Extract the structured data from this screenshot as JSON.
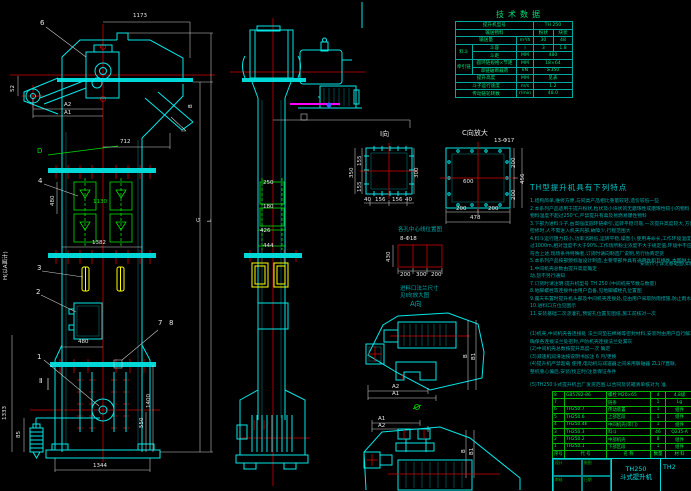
{
  "tech_table": {
    "title": "技术数据",
    "rows": [
      {
        "label": "提升机型号",
        "unit": "",
        "v1": "TH 250",
        "v2": ""
      },
      {
        "label": "输送物料",
        "unit": "",
        "v1": "粉状",
        "v2": "块状"
      },
      {
        "label": "输送量",
        "unit": "m³/h",
        "v1": "30",
        "v2": "48"
      },
      {
        "group": "料斗",
        "label": "斗容",
        "unit": "l",
        "v1": "3",
        "v2": "1.8"
      },
      {
        "group": "料斗",
        "label": "斗距",
        "unit": "MM",
        "v1": "480",
        "v2": ""
      },
      {
        "group": "牵引链",
        "label": "圆环链规格×节距",
        "unit": "MM",
        "v1": "18×64",
        "v2": ""
      },
      {
        "group": "牵引链",
        "label": "单链破断载荷",
        "unit": "kN",
        "v1": "≥350",
        "v2": ""
      },
      {
        "label": "提升高度",
        "unit": "MM",
        "v1": "见表",
        "v2": ""
      },
      {
        "label": "斗子运行速度",
        "unit": "m/s",
        "v1": "1.2",
        "v2": ""
      },
      {
        "label": "传动链轮转数",
        "unit": "r/min",
        "v1": "48.0",
        "v2": ""
      }
    ]
  },
  "notes": {
    "title": "TH型提升机具有下列特点",
    "side_note": "安装尺寸详见基础图(如图示)",
    "lines": [
      "1.结构简单,维修方便,与同类产品相比重量较轻,造价较低一些",
      "2.本系列产品适用于提升粉状,粒状及小块状的无磨琢性或磨琢性较小的物料 如煤,水泥,石子,砂等",
      "   物料温度不超过250℃,严禁提升有毒及易燃易爆性物料",
      "3.下部为进料斗子,由高强度圆环链牵引,运转平稳可靠,一次提升高度较大,方便布置,可",
      "   检修时,人不需进入机壳内部,故障少,行程范围大",
      "4.料斗运行阻力较小,功率消耗低,运转平稳,噪音小,使用寿命长,工作环境温度为-20℃~+40℃,海拔不超",
      "   过1000m,相对湿度不大于90%,工作场所粉尘浓度不大于规定值,环境中不应含易燃易爆性气体,若不",
      "   符合上述,现场条件特殊者,订货时请向制造厂说明,另行协商定货",
      "5.本系列产品按部颁标准设计制造,主要零部件具有通用性和互换性,本图供土建设计选用,若尺寸有变",
      "1.中间机壳总数由提升高度确定",
      "   动,恕不另行通知",
      "7.订货时请注明:提升机型号 TH 250 (中间机壳节数与数量)",
      "8.地脚螺栓等连接件由用户自备,见地脚螺栓孔位置图",
      "9.露天布置时提升机头部及中间机壳连接处,应由用户采取防雨措施,防止雨水进入机壳内",
      "10.进料口方位见图示",
      "11.安装基础二次浇灌孔,预留孔位置见图纸,施工前核对一次",
      "(1)机壳,中间机壳各连接处 法兰间垫石棉绳等密封材料,安装时由用户自行解决,",
      "   确保各连接法兰处密封,严防机壳连接法兰处漏灰",
      "(2)中间机壳总数按提升高度一次 确定",
      "(3)减速机润滑油按说明书加注 6 月/更换",
      "(4)提升机严禁超载 使用,电动机与减速器之间采用联轴器 ZL1/Y直联,",
      "   整机重心偏后,安装/找正时/注意保证条件",
      "(5)TH250斗式提升机出厂发货范围,以合同及装箱清单核对为 准."
    ]
  },
  "bom": {
    "headers": {
      "num": "序号",
      "code": "代 号",
      "name": "名 称",
      "qty": "数量",
      "mat": "材 料",
      "note": "备注"
    },
    "rows": [
      {
        "num": "8",
        "code": "GB5782-86",
        "name": "螺栓 M20×65",
        "qty": "4",
        "mat": "4.8级",
        "note": "附件"
      },
      {
        "num": "7",
        "code": "",
        "name": "链条",
        "qty": "1",
        "mat": "Lg",
        "note": "0.06"
      },
      {
        "num": "6",
        "code": "TH250.7",
        "name": "传动装置",
        "qty": "1",
        "mat": "组件",
        "note": ""
      },
      {
        "num": "5",
        "code": "TH250.6",
        "name": "上部区段",
        "qty": "1",
        "mat": "组件",
        "note": "配对"
      },
      {
        "num": "4",
        "code": "TH250.4Ⅱ",
        "name": "中间机壳(带门)",
        "qty": "1",
        "mat": "组件",
        "note": ""
      },
      {
        "num": "3",
        "code": "TH250.3",
        "name": "料斗",
        "qty": "46",
        "mat": "Q235-A",
        "note": "204"
      },
      {
        "num": "2",
        "code": "TH250.2",
        "name": "中部机壳",
        "qty": "8",
        "mat": "组件",
        "note": ""
      },
      {
        "num": "1",
        "code": "TH250.1",
        "name": "下部区段",
        "qty": "1",
        "mat": "组件",
        "note": "配重"
      }
    ]
  },
  "title_block": {
    "model": "TH250",
    "name": "斗式提升机",
    "drawing_no": "TH2",
    "left_cells": [
      "设计",
      "制图",
      "审核",
      "日期"
    ]
  },
  "labels": {
    "dim_1173": "1173",
    "callout_6": "6",
    "dim_52": "52",
    "dim_a2": "A2",
    "dim_a1": "A1",
    "dim_712": "712",
    "letter_b": "B",
    "letter_d": "D",
    "callout_4": "4",
    "dim_480_mid": "480",
    "dim_1130": "1130",
    "dim_1382": "1382",
    "callout_3": "3",
    "callout_2": "2",
    "callout_7": "7",
    "callout_8": "8",
    "dim_h": "H(以A面计)",
    "letter_g": "G",
    "letter_l": "L",
    "callout_1": "1",
    "section_ii": "Ⅱ",
    "dim_480_boot": "480",
    "dim_1400": "1400",
    "dim_550": "550",
    "dim_1344": "1344",
    "dim_1333": "1333",
    "dim_85": "85",
    "dim_250": "250",
    "dim_180": "180",
    "dim_426": "426",
    "dim_444": "444",
    "view_i_title": "Ⅰ向",
    "dim_350": "350",
    "dim_155a": "155",
    "dim_155b": "155",
    "dim_300": "300",
    "dim_40a": "40",
    "dim_156a": "156",
    "dim_156b": "156",
    "dim_40b": "40",
    "view_c_title": "C向放大",
    "bolt_note_c": "13-Φ17",
    "dim_c600": "600",
    "dim_c200a": "200",
    "dim_c200b": "200",
    "dim_c456": "456",
    "dim_c200c": "200",
    "dim_c200d": "200",
    "dim_c478": "478",
    "anchor_title": "各孔中心线位置图",
    "bolt_note_anchor": "8-Φ18",
    "dim_430": "430",
    "dim_an200a": "200",
    "dim_an300": "300",
    "dim_an200b": "200",
    "flange_note_1": "进料口法兰尺寸",
    "flange_note_2": "见Ⅰ向放大图",
    "view_a_title": "A向",
    "d1_a2": "A2",
    "d1_a1": "A1",
    "d1_b": "B",
    "d1_b1": "B1",
    "d2_a1": "A1",
    "d2_a2": "A2",
    "d2_b": "B",
    "d2_b1": "B1"
  },
  "colors": {
    "line_cyan": "#00e8e8",
    "centerline_red": "#d40000",
    "dim_white": "#e8e8e8",
    "part_green": "#00e000",
    "bucket_yellow": "#ffff00",
    "accent_magenta": "#ff00ff",
    "note_teal": "#00a8a8",
    "table_green": "#00dd77",
    "bom_green": "#00ee44"
  }
}
